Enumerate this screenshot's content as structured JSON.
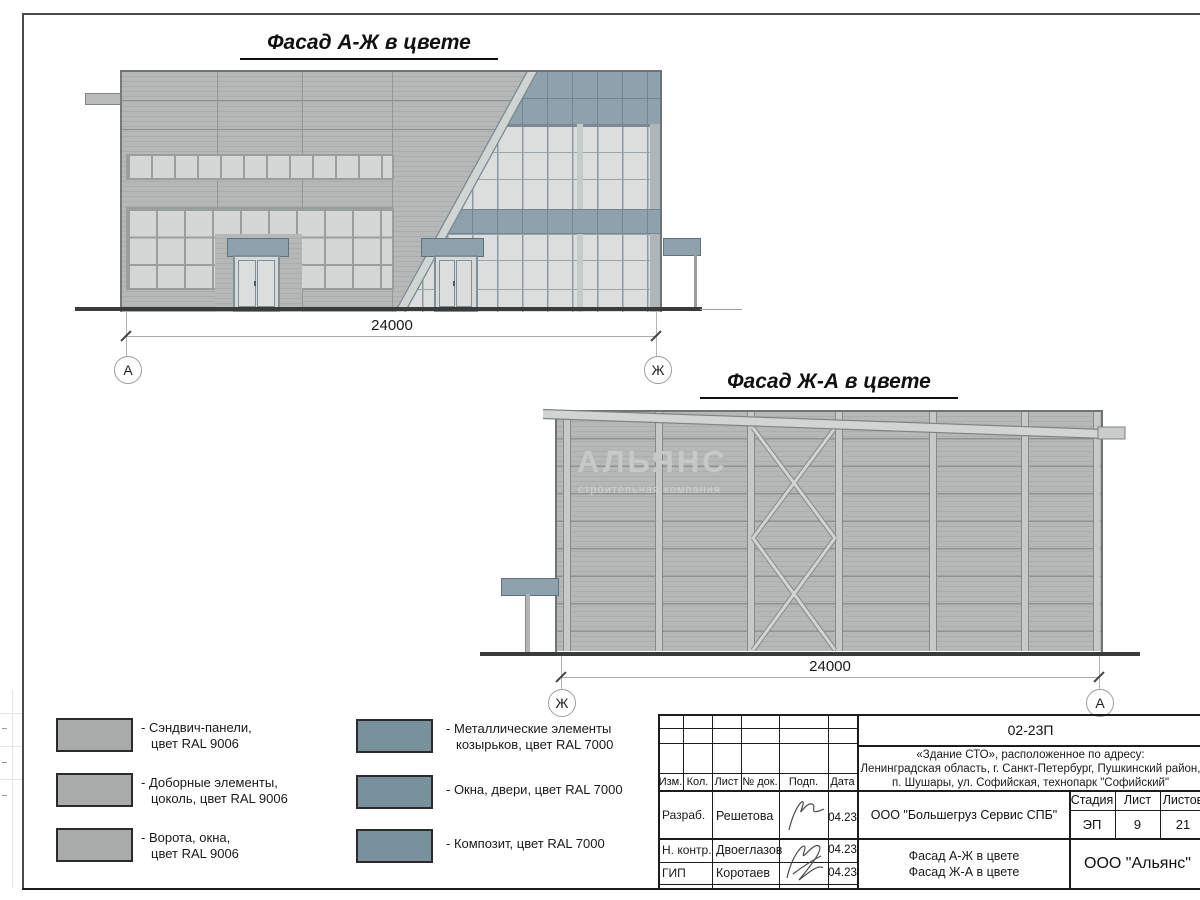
{
  "drawing": {
    "facade_aj": {
      "title": "Фасад А-Ж в цвете",
      "dimension": "24000",
      "axis_left": "А",
      "axis_right": "Ж"
    },
    "facade_ja": {
      "title": "Фасад Ж-А в цвете",
      "dimension": "24000",
      "axis_left": "Ж",
      "axis_right": "А"
    },
    "watermark": {
      "title": "АЛЬЯНС",
      "subtitle": "строительная компания"
    }
  },
  "legend": {
    "colors": {
      "ral9006": "#a8aba9",
      "ral7000": "#78919c"
    },
    "items": [
      {
        "line1": "- Сэндвич-панели,",
        "line2": "цвет RAL 9006"
      },
      {
        "line1": "- Доборные элементы,",
        "line2": "цоколь, цвет RAL 9006"
      },
      {
        "line1": "- Ворота, окна,",
        "line2": "цвет RAL 9006"
      },
      {
        "line1": "- Металлические элементы",
        "line2": "козырьков, цвет RAL 7000"
      },
      {
        "line1": "- Окна, двери, цвет RAL 7000",
        "line2": ""
      },
      {
        "line1": "- Композит, цвет RAL 7000",
        "line2": ""
      }
    ]
  },
  "titleblock": {
    "doc_code": "02-23П",
    "project_line1": "«Здание СТО», расположенное по адресу:",
    "project_line2": "Ленинградская область, г. Санкт-Петербург, Пушкинский район,",
    "project_line3": "п. Шушары, ул. Софийская, технопарк \"Софийский\"",
    "col_izm": "Изм.",
    "col_kol": "Кол.",
    "col_list": "Лист",
    "col_ndok": "№ док.",
    "col_podp": "Подп.",
    "col_data": "Дата",
    "row1_role": "Разраб.",
    "row1_name": "Решетова",
    "row1_date": "04.23",
    "row2_role": "Н. контр.",
    "row2_name": "Двоеглазов",
    "row2_date": "04.23",
    "row3_role": "ГИП",
    "row3_name": "Коротаев",
    "row3_date": "04.23",
    "client": "ООО \"Большегруз Сервис СПБ\"",
    "stage_label": "Стадия",
    "sheet_label": "Лист",
    "sheets_label": "Листов",
    "stage": "ЭП",
    "sheet": "9",
    "sheets": "21",
    "content_line1": "Фасад А-Ж в цвете",
    "content_line2": "Фасад Ж-А в цвете",
    "company": "ООО \"Альянс\""
  }
}
